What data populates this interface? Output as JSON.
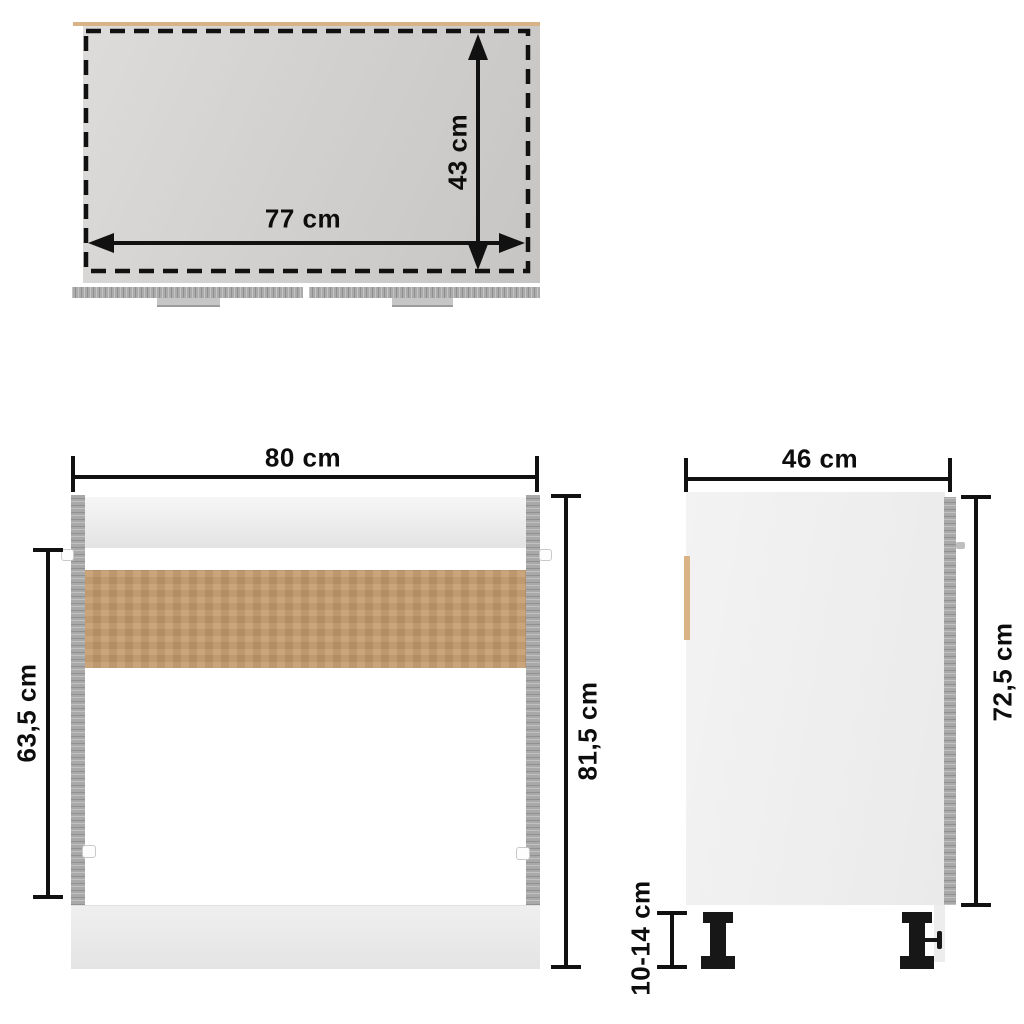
{
  "diagram": {
    "subject": "sink bottom cabinet dimension drawing",
    "views": {
      "top_view": {
        "width": "77 cm",
        "depth": "43 cm"
      },
      "front_view": {
        "width": "80 cm",
        "inner_height": "63,5 cm",
        "total_height": "81,5 cm"
      },
      "side_view": {
        "depth": "46 cm",
        "body_height": "72,5 cm",
        "leg_height": "10-14 cm"
      }
    },
    "colors": {
      "dimension_line": "#111111",
      "worktop_gray": "#d2d0ce",
      "panel_gray": "#a9a9a9",
      "back_panel_brown": "#c49b6d",
      "handle_tan": "#d9b385",
      "leg_black": "#171717",
      "background": "#ffffff"
    }
  }
}
